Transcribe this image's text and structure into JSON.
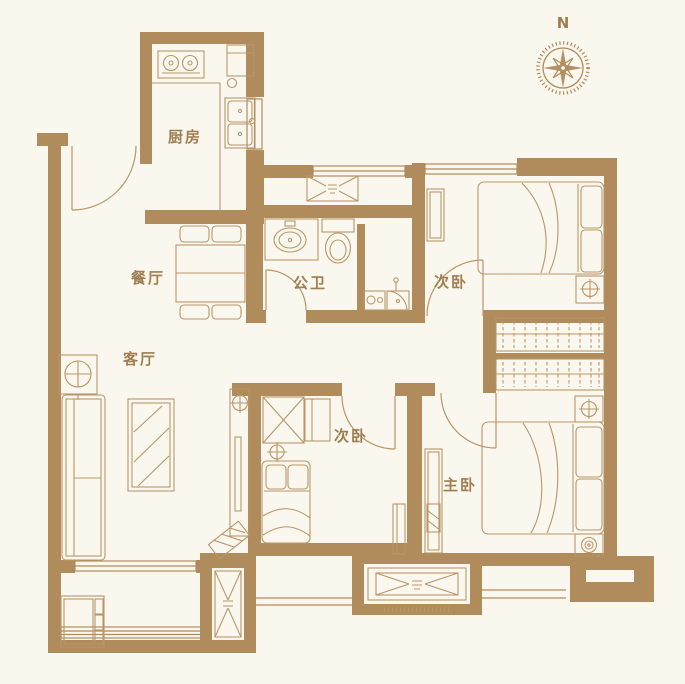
{
  "floorplan": {
    "compass": {
      "label": "N"
    },
    "colors": {
      "background": "#faf7ee",
      "wall": "#b08b5c",
      "line": "#b99668",
      "label": "#a07e52"
    },
    "rooms": [
      {
        "id": "kitchen",
        "label": "厨房"
      },
      {
        "id": "dining-room",
        "label": "餐厅"
      },
      {
        "id": "bathroom",
        "label": "公卫"
      },
      {
        "id": "bedroom-north",
        "label": "次卧"
      },
      {
        "id": "living-room",
        "label": "客厅"
      },
      {
        "id": "bedroom-center",
        "label": "次卧"
      },
      {
        "id": "master-bedroom",
        "label": "主卧"
      }
    ],
    "icons": {
      "compass": "compass-rose",
      "ceiling-lamp": "circle-cross",
      "duct-shaft": "x-box",
      "entry-marker": "x-box",
      "wardrobe": "hanging-clothes-hatch"
    }
  }
}
